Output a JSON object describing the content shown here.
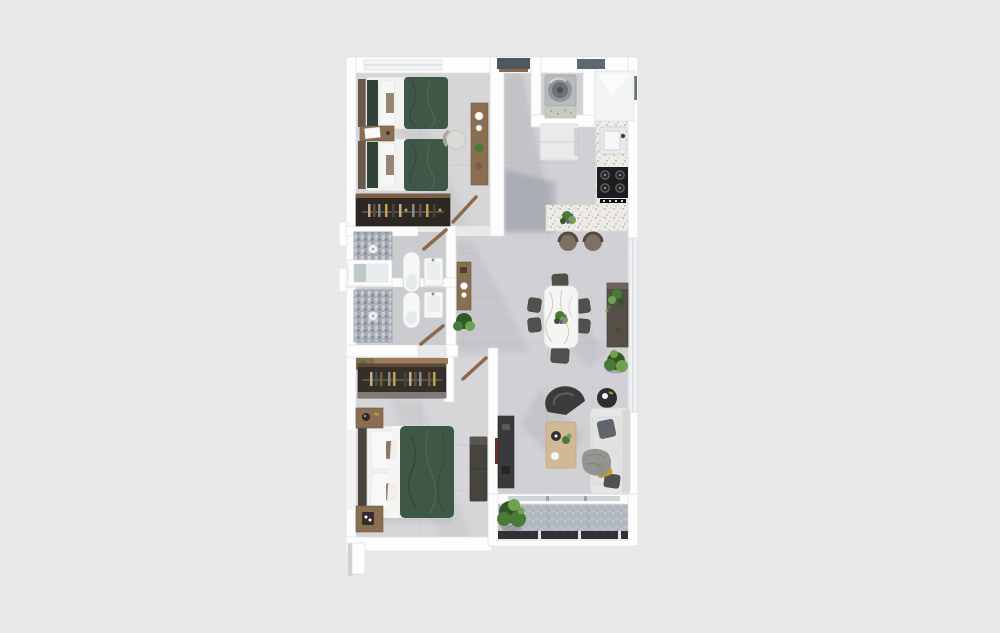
{
  "scene": {
    "type": "3d-floor-plan-top-down-render",
    "subject": "two-bedroom apartment with open kitchen, living-dining area and balcony",
    "background": "plain light gray, plan centered, no text or labels rendered"
  },
  "palette": {
    "page-bg": "#e9e9e9",
    "wall": "#fdfdfd",
    "wall-edge": "#dcdfe2",
    "wall-shadow": "#c9d0d6",
    "floor-main": "#d1d1d5",
    "floor-bedroom": "#d6d5d8",
    "floor-bath": "#cbccd0",
    "tile-line": "#c0c0c6",
    "balcony-floor": "#b4bac2",
    "railing": "#303234",
    "duvet-green": "#3f5747",
    "linen-white": "#f2f2f0",
    "wood": "#8a6e51",
    "wardrobe-dark": "#2d2823",
    "closet-dark": "#352f29",
    "brass": "#c2a04e",
    "mosaic-base": "#aab0b8",
    "mosaic-dark": "#8d939c",
    "mosaic-light": "#c9ced5",
    "fixture-white": "#f6f7f7",
    "fixture-line": "#cfd3d4",
    "terrazzo": "#edece6",
    "stove-black": "#1c1d1e",
    "fridge-white": "#e9eaea",
    "stool-brown": "#7d7165",
    "marble-white": "#f6f5f3",
    "marble-vein": "#b6b1ab",
    "chair-gray": "#4f524c",
    "sideboard-brown": "#564f48",
    "plant-green": "#4a7a37",
    "plant-green-light": "#6fa24f",
    "plant-green-dark": "#335726",
    "flower-purple": "#7b4fa0",
    "sofa-light": "#e6e6e4",
    "pillow-gray": "#5f656b",
    "pillow-mustard": "#c29a3a",
    "throw-gray": "#8f918c",
    "lounge-dark": "#3a3c3b",
    "table-wood-light": "#d2b995",
    "console-dark": "#37393b",
    "window-slot": "#4c575e",
    "glass": "#ccd6d9",
    "door-wood": "#8a6a4a"
  },
  "rooms": [
    {
      "name": "bedroom-2",
      "furniture": [
        "twin-bed",
        "twin-bed",
        "nightstand",
        "desk",
        "desk-chair",
        "wardrobe"
      ]
    },
    {
      "name": "entry-hall",
      "furniture": [
        "entry-door"
      ]
    },
    {
      "name": "laundry-nook",
      "furniture": [
        "washing-machine",
        "speckled-counter"
      ]
    },
    {
      "name": "kitchen",
      "furniture": [
        "tall-cabinet",
        "sink",
        "cooktop",
        "refrigerator",
        "l-shaped-terrazzo-counter",
        "bar-stool",
        "bar-stool",
        "counter-plant"
      ]
    },
    {
      "name": "bathroom-1",
      "furniture": [
        "mosaic-shower",
        "toilet",
        "washbasin",
        "door"
      ]
    },
    {
      "name": "bathroom-2",
      "furniture": [
        "mosaic-shower",
        "toilet",
        "washbasin",
        "door"
      ]
    },
    {
      "name": "hallway",
      "furniture": [
        "wall-console",
        "floor-plant"
      ]
    },
    {
      "name": "dining-area",
      "furniture": [
        "marble-dining-table",
        "dining-chair",
        "dining-chair",
        "dining-chair",
        "dining-chair",
        "dining-chair",
        "dining-chair",
        "sideboard",
        "sideboard-plant",
        "floor-plant"
      ]
    },
    {
      "name": "living-area",
      "furniture": [
        "lounge-chair",
        "round-side-table",
        "sofa",
        "gray-pillow",
        "mustard-pillow",
        "throw-blanket",
        "coffee-table",
        "tv-console"
      ]
    },
    {
      "name": "master-bedroom",
      "furniture": [
        "double-bed",
        "nightstand",
        "nightstand",
        "open-closet",
        "dresser",
        "door"
      ]
    },
    {
      "name": "balcony",
      "furniture": [
        "planter",
        "railing",
        "sliding-glass-door"
      ]
    }
  ]
}
